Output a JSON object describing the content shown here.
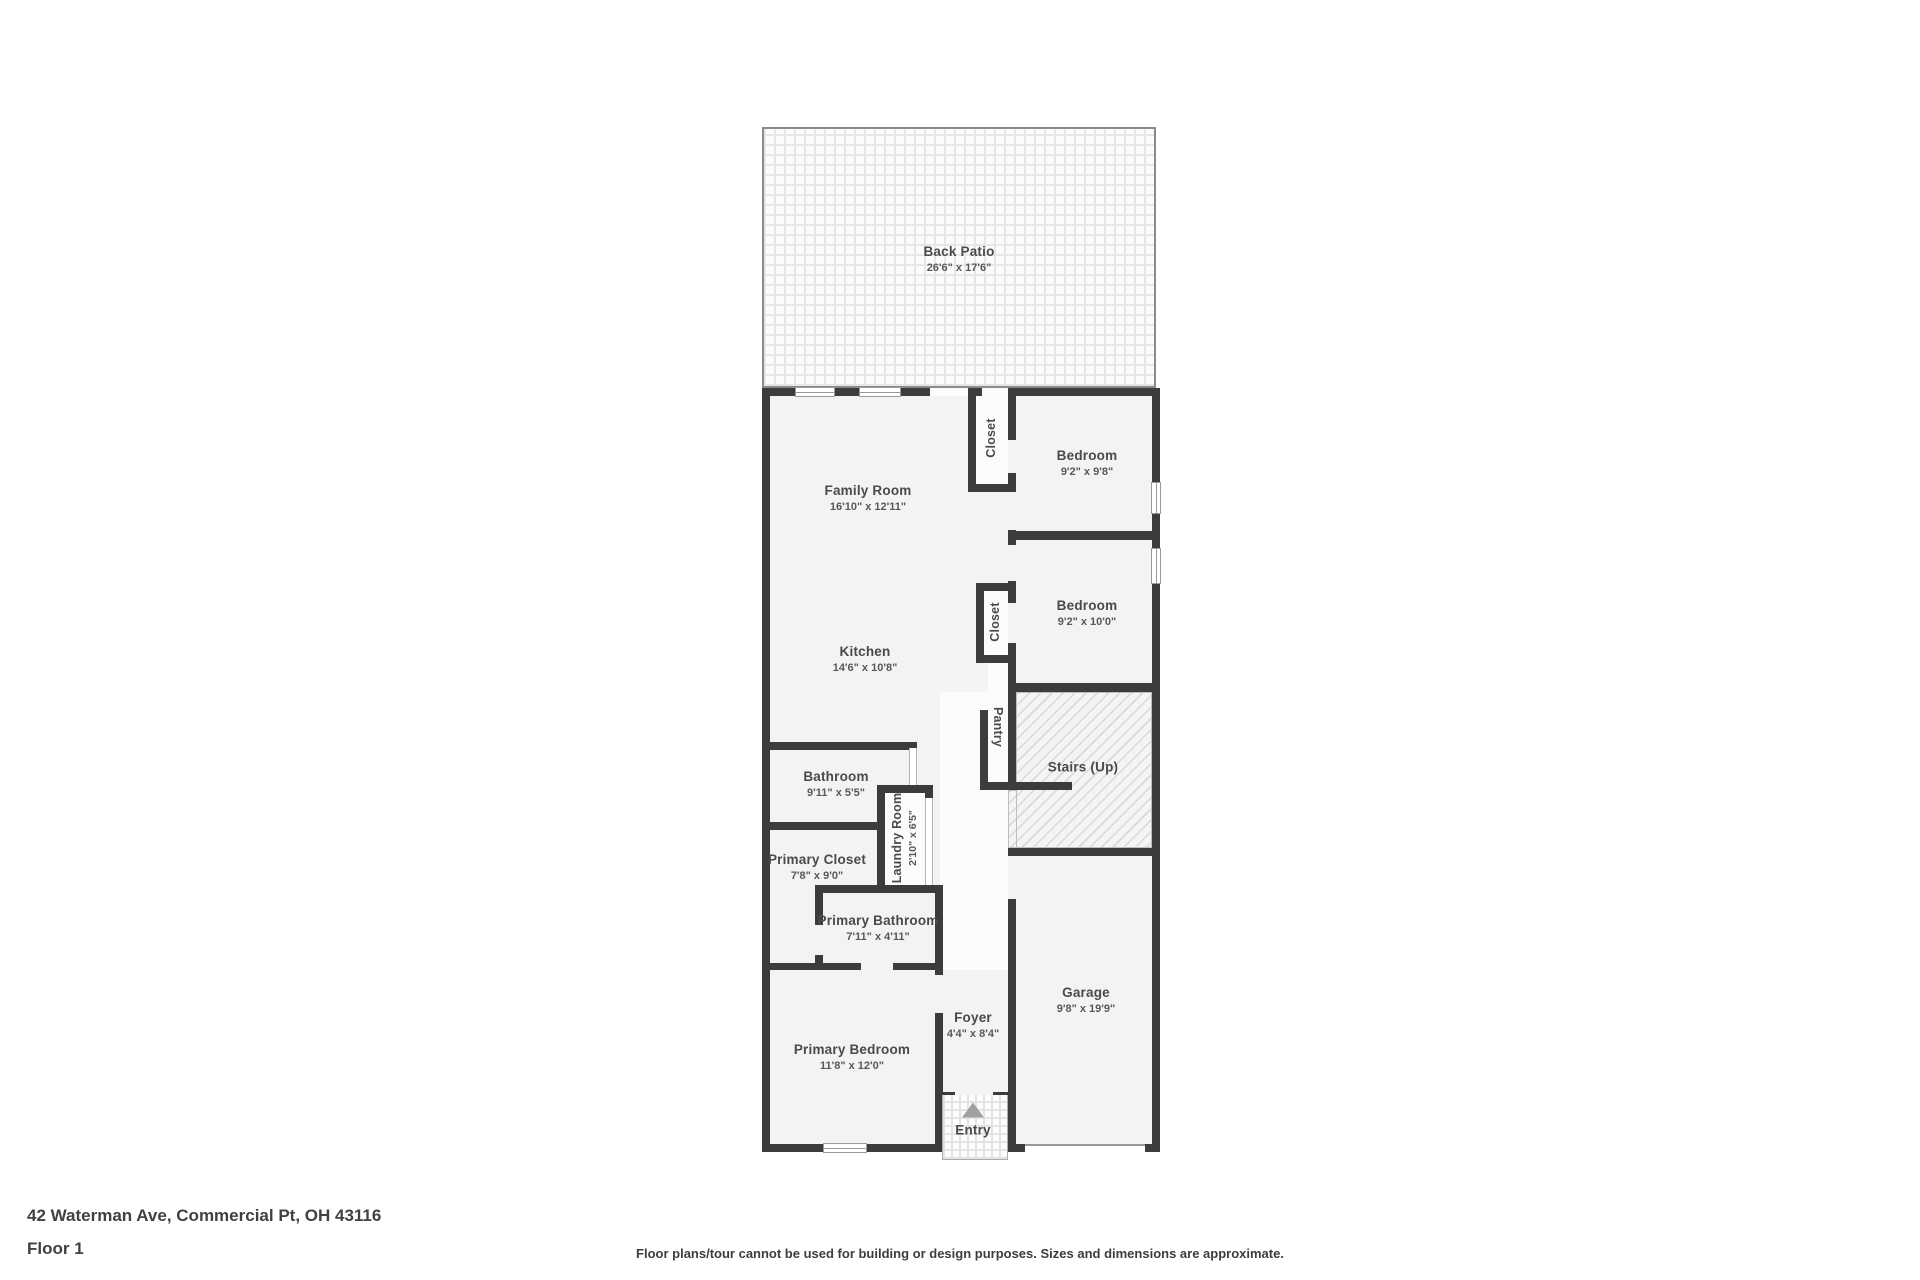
{
  "meta": {
    "address": "42 Waterman Ave, Commercial Pt, OH 43116",
    "floor_label": "Floor 1",
    "disclaimer": "Floor plans/tour cannot be used for building or design purposes. Sizes and dimensions are approximate."
  },
  "colors": {
    "wall": "#3c3c3c",
    "room_fill": "#f3f3f3",
    "label_text": "#4a4a4a",
    "page_background": "#ffffff"
  },
  "rooms": {
    "back_patio": {
      "name": "Back Patio",
      "dims": "26'6\" x 17'6\""
    },
    "family_room": {
      "name": "Family Room",
      "dims": "16'10\" x 12'11\""
    },
    "kitchen": {
      "name": "Kitchen",
      "dims": "14'6\" x 10'8\""
    },
    "closet_1": {
      "name": "Closet"
    },
    "bedroom_1": {
      "name": "Bedroom",
      "dims": "9'2\" x 9'8\""
    },
    "closet_2": {
      "name": "Closet"
    },
    "bedroom_2": {
      "name": "Bedroom",
      "dims": "9'2\" x 10'0\""
    },
    "pantry": {
      "name": "Pantry"
    },
    "stairs": {
      "name": "Stairs (Up)"
    },
    "bathroom": {
      "name": "Bathroom",
      "dims": "9'11\" x 5'5\""
    },
    "laundry": {
      "name": "Laundry Room",
      "dims": "2'10\" x 6'5\""
    },
    "primary_closet": {
      "name": "Primary Closet",
      "dims": "7'8\" x 9'0\""
    },
    "primary_bathroom": {
      "name": "Primary Bathroom",
      "dims": "7'11\" x 4'11\""
    },
    "foyer": {
      "name": "Foyer",
      "dims": "4'4\" x 8'4\""
    },
    "primary_bedroom": {
      "name": "Primary Bedroom",
      "dims": "11'8\" x 12'0\""
    },
    "garage": {
      "name": "Garage",
      "dims": "9'8\" x 19'9\""
    },
    "entry": {
      "name": "Entry"
    }
  }
}
